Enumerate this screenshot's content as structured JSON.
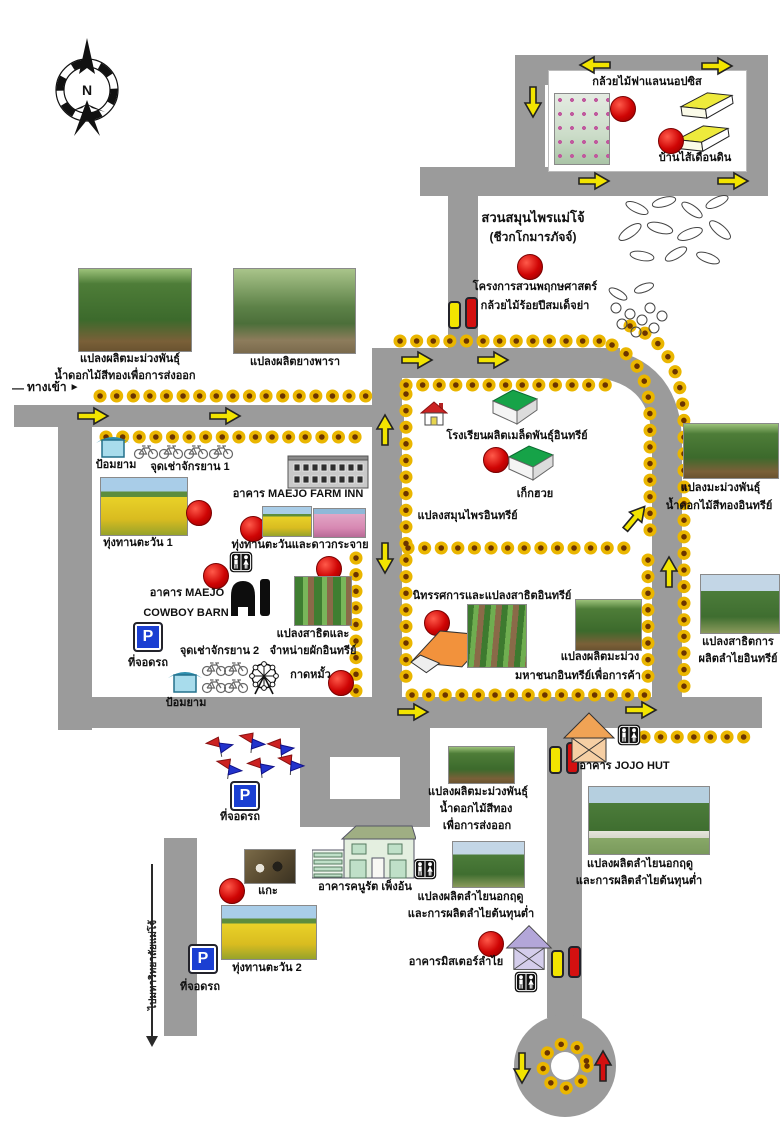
{
  "colors": {
    "road": "#9b9b9b",
    "arrow_yellow": "#f2e400",
    "arrow_red": "#d41010",
    "marker_red": "#cf0404",
    "sunflower_gold": "#eab600",
    "sunflower_core": "#6b3400",
    "parking_blue": "#1b3fd2"
  },
  "signs": {
    "parking": "P"
  },
  "compass": {
    "north": "N"
  },
  "entrance": {
    "dash": "—",
    "label": "ทางเข้า",
    "pointer": "►"
  },
  "exit_road": {
    "label": "ไปมหาวิทยาลัยแม่โจ้"
  },
  "orchid_house": {
    "title": "กล้วยไม้ฟาแลนนอปซิส",
    "earthworm": "บ้านไส้เดือนดิน"
  },
  "herb_garden": {
    "line1": "สวนสมุนไพรแม่โจ้",
    "line2": "(ชีวกโกมารภัจจ์)",
    "line3": "โครงการสวนพฤกษศาสตร์",
    "line4": "กล้วยไม้ร้อยปีสมเด็จย่า"
  },
  "top_plots": {
    "mango1": "แปลงผลิตมะม่วงพันธุ์",
    "mango2": "น้ำดอกไม้สีทองเพื่อการส่งออก",
    "rubber": "แปลงผลิตยางพารา"
  },
  "left_zone": {
    "guard": "ป้อมยาม",
    "bike1": "จุดเช่าจักรยาน 1",
    "farm_inn": "อาคาร MAEJO FARM INN",
    "sunflower1": "ทุ่งทานตะวัน 1",
    "sunflower_cosmos": "ทุ่งทานตะวันและดาวกระจาย",
    "maejo": "อาคาร MAEJO",
    "cowboy": "COWBOY BARN",
    "parking": "ที่จอดรถ",
    "bike2": "จุดเช่าจักรยาน 2",
    "demo1": "แปลงสาธิตและ",
    "demo2": "จำหน่ายผักอินทรีย์",
    "market": "กาดหมั้ว"
  },
  "school_zone": {
    "school": "โรงเรียนผลิตเมล็ดพันธุ์อินทรีย์",
    "chrysanthemum": "เก็กฮวย",
    "herb_plot": "แปลงสมุนไพรอินทรีย์"
  },
  "exhibition_zone": {
    "title": "นิทรรศการและแปลงสาธิตอินทรีย์",
    "mango1": "แปลงผลิตมะม่วง",
    "mango2": "มหาชนกอินทรีย์เพื่อการค้า"
  },
  "right_zone": {
    "mango1": "แปลงมะม่วงพันธุ์",
    "mango2": "น้ำดอกไม้สีทองอินทรีย์",
    "longan1": "แปลงสาธิตการ",
    "longan2": "ผลิตลำไยอินทรีย์"
  },
  "jojo": {
    "label": "อาคาร JOJO HUT"
  },
  "south_zone": {
    "mango1": "แปลงผลิตมะม่วงพันธุ์",
    "mango2": "น้ำดอกไม้สีทอง",
    "mango3": "เพื่อการส่งออก",
    "longan1": "แปลงผลิตลำไยนอกฤดู",
    "longan2": "และการผลิตลำไยต้นทุนต่ำ",
    "kanurat": "อาคารคนูรัต เพ็งอ้น",
    "sheep": "แกะ",
    "sunflower2": "ทุ่งทานตะวัน 2",
    "mister_longan": "อาคารมิสเตอร์ลำไย"
  }
}
